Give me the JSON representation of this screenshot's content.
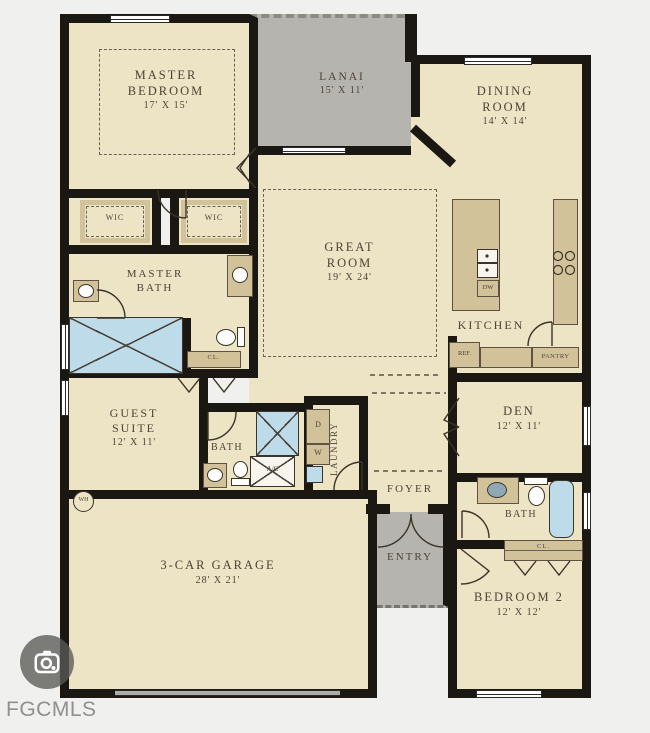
{
  "plan": {
    "rooms": {
      "master_bedroom": {
        "label": "MASTER BEDROOM",
        "dims": "17' X 15'"
      },
      "lanai": {
        "label": "LANAI",
        "dims": "15' X 11'"
      },
      "dining_room": {
        "label": "DINING ROOM",
        "dims": "14' X 14'"
      },
      "great_room": {
        "label": "GREAT ROOM",
        "dims": "19' X 24'"
      },
      "kitchen": {
        "label": "KITCHEN"
      },
      "master_bath": {
        "label": "MASTER BATH"
      },
      "wic_left": {
        "label": "WIC"
      },
      "wic_right": {
        "label": "WIC"
      },
      "guest_suite": {
        "label": "GUEST SUITE",
        "dims": "12' X 11'"
      },
      "guest_bath": {
        "label": "BATH"
      },
      "laundry": {
        "label": "LAUNDRY"
      },
      "den": {
        "label": "DEN",
        "dims": "12' X 11'"
      },
      "foyer": {
        "label": "FOYER"
      },
      "entry": {
        "label": "ENTRY"
      },
      "bath_2": {
        "label": "BATH"
      },
      "closet_master": {
        "label": "CL."
      },
      "closet_bed2": {
        "label": "CL."
      },
      "bedroom_2": {
        "label": "BEDROOM 2",
        "dims": "12' X 12'"
      },
      "garage": {
        "label": "3-CAR GARAGE",
        "dims": "28' X 21'"
      }
    },
    "fixtures": {
      "dishwasher": "DW",
      "refrigerator": "REF.",
      "pantry": "PANTRY",
      "ac_unit": "A/C",
      "dryer": "D",
      "washer": "W",
      "water_heater": "WH"
    }
  },
  "watermark": {
    "agency": "FGCMLS"
  },
  "colors": {
    "wall": "#1b1712",
    "floor": "#ede3c5",
    "porch": "#b6b4ae",
    "counter": "#d2c29a",
    "fixture": "#bedbe9",
    "ink": "#4e4336",
    "bg": "#f0f0ee",
    "watermark": "#8f8f8f",
    "dashed": "#6b6156"
  }
}
